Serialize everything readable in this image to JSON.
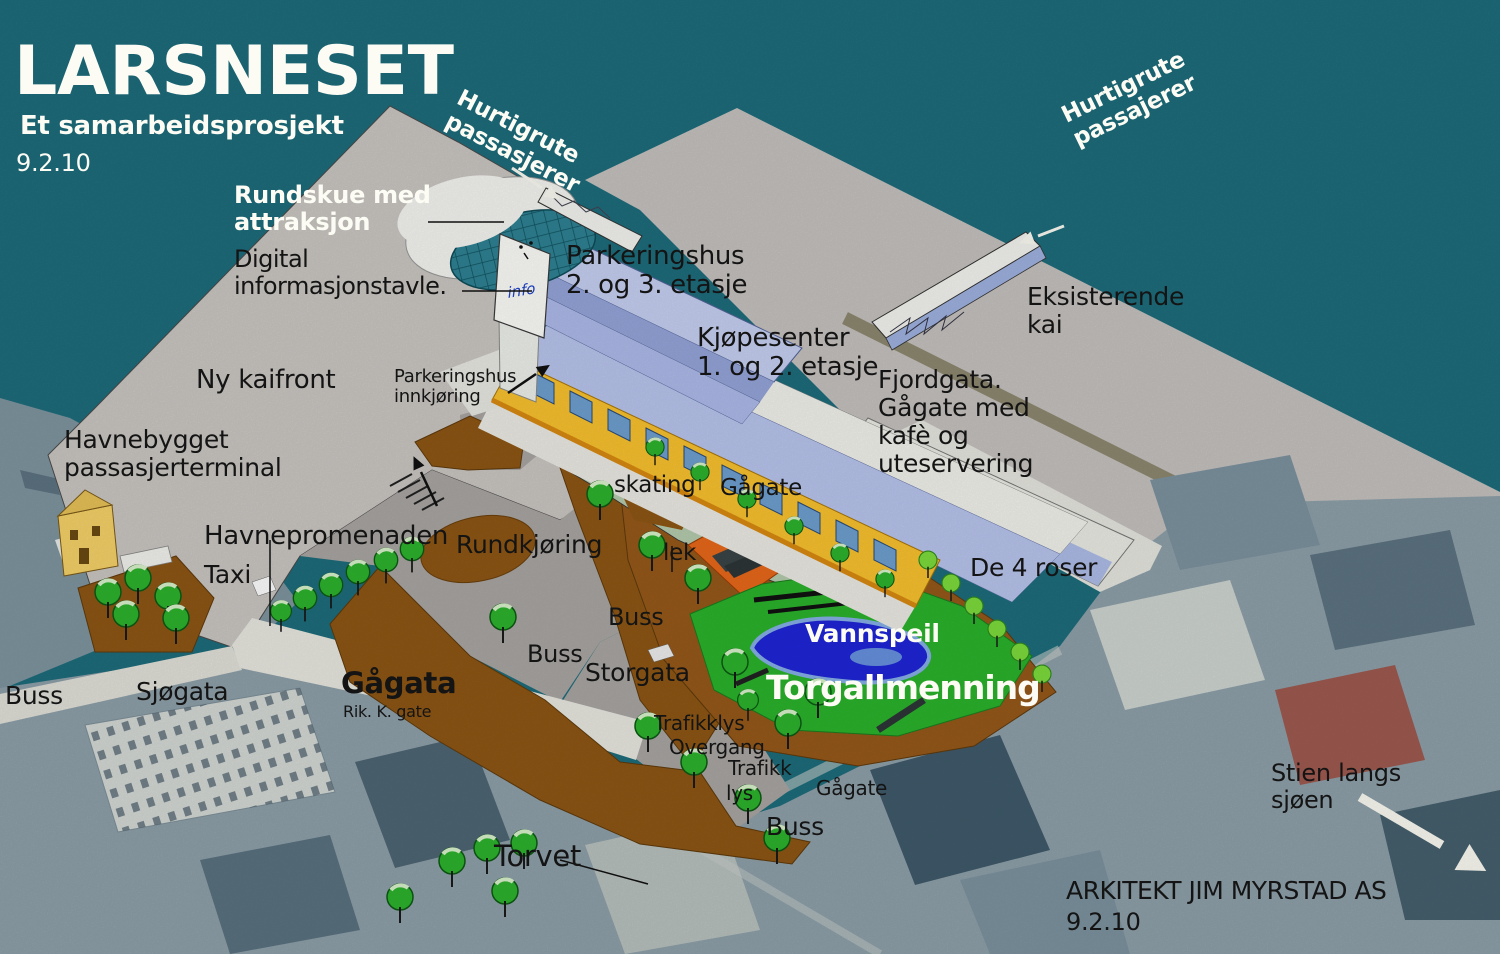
{
  "map": {
    "info_sign": "info"
  },
  "colors": {
    "water": "#1e6d7c",
    "new_quay": "#cbc7c3",
    "existing_quay": "#c6c2bf",
    "park_green": "#2bb32c",
    "skate_park_sage": "#b6ccae",
    "pond_blue": "#1f25d8",
    "earth_brown": "#8e5714",
    "facade_yellow": "#f9c22e",
    "parking_blue": "#aebbea",
    "roof_blue": "#b9c5ee",
    "dome_teal": "#2f8294",
    "tree_green": "#2db32d"
  },
  "annotations": [
    {
      "name": "title",
      "text": "LARSNESET",
      "x": 14,
      "y": 34,
      "size": 68,
      "color": "white",
      "bold": true
    },
    {
      "name": "subtitle",
      "text": "Et samarbeidsprosjekt",
      "x": 20,
      "y": 112,
      "size": 26,
      "color": "white",
      "bold": true
    },
    {
      "name": "title-date",
      "text": "9.2.10",
      "x": 16,
      "y": 150,
      "size": 24,
      "color": "white"
    },
    {
      "name": "hurtigrute-left",
      "text": "Hurtigrute\npassasjerer",
      "x": 464,
      "y": 86,
      "size": 23,
      "color": "white",
      "bold": true,
      "rot": 27
    },
    {
      "name": "rundskue",
      "text": "Rundskue med\nattraksjon",
      "x": 234,
      "y": 182,
      "size": 24,
      "color": "white",
      "bold": true
    },
    {
      "name": "digital-informasjonstavle",
      "text": "Digital\ninformasjonstavle.",
      "x": 234,
      "y": 246,
      "size": 24,
      "color": "black",
      "ls": -0.5
    },
    {
      "name": "parkeringshus",
      "text": "Parkeringshus\n2. og 3. etasje",
      "x": 566,
      "y": 242,
      "size": 26,
      "color": "black"
    },
    {
      "name": "kjopesenter",
      "text": "Kjøpesenter\n1. og 2. etasje",
      "x": 697,
      "y": 324,
      "size": 26,
      "color": "black"
    },
    {
      "name": "hurtigrute-right",
      "text": "Hurtigrute\npassajerer",
      "x": 1058,
      "y": 106,
      "size": 23,
      "color": "white",
      "bold": true,
      "rot": -26
    },
    {
      "name": "eksisterende-kai",
      "text": "Eksisterende\nkai",
      "x": 1027,
      "y": 283,
      "size": 25,
      "color": "black"
    },
    {
      "name": "fjordgata",
      "text": "Fjordgata.\nGågate med\nkafè og\nuteservering",
      "x": 878,
      "y": 366,
      "size": 25,
      "color": "black"
    },
    {
      "name": "ny-kaifront",
      "text": "Ny kaifront",
      "x": 196,
      "y": 366,
      "size": 26,
      "color": "black"
    },
    {
      "name": "parkeringshus-innkjoring",
      "text": "Parkeringshus\ninnkjøring",
      "x": 394,
      "y": 367,
      "size": 18,
      "color": "black"
    },
    {
      "name": "havnebygget",
      "text": "Havnebygget\npassasjerterminal",
      "x": 64,
      "y": 426,
      "size": 25,
      "color": "black"
    },
    {
      "name": "havnepromenaden",
      "text": "Havnepromenaden",
      "x": 204,
      "y": 522,
      "size": 26,
      "color": "black"
    },
    {
      "name": "taxi",
      "text": "Taxi",
      "x": 204,
      "y": 561,
      "size": 25,
      "color": "black"
    },
    {
      "name": "rundkjoring",
      "text": "Rundkjøring",
      "x": 456,
      "y": 531,
      "size": 25,
      "color": "black"
    },
    {
      "name": "skating",
      "text": "skating",
      "x": 614,
      "y": 473,
      "size": 23,
      "color": "black"
    },
    {
      "name": "gagate-upper",
      "text": "Gågate",
      "x": 720,
      "y": 476,
      "size": 23,
      "color": "black"
    },
    {
      "name": "lek",
      "text": "lek",
      "x": 663,
      "y": 541,
      "size": 23,
      "color": "black"
    },
    {
      "name": "buss-lekepark",
      "text": "Buss",
      "x": 608,
      "y": 604,
      "size": 24,
      "color": "black"
    },
    {
      "name": "buss-storgata",
      "text": "Buss",
      "x": 527,
      "y": 641,
      "size": 24,
      "color": "black"
    },
    {
      "name": "storgata",
      "text": "Storgata",
      "x": 585,
      "y": 659,
      "size": 25,
      "color": "black"
    },
    {
      "name": "vannspeil",
      "text": "Vannspeil",
      "x": 805,
      "y": 620,
      "size": 25,
      "color": "white",
      "bold": true
    },
    {
      "name": "torgallmenning",
      "text": "Torgallmenning",
      "x": 766,
      "y": 670,
      "size": 33,
      "color": "white",
      "bold": true,
      "ls": -1
    },
    {
      "name": "de-4-roser",
      "text": "De 4 roser",
      "x": 970,
      "y": 554,
      "size": 25,
      "color": "black"
    },
    {
      "name": "trafikklys",
      "text": "Trafikklys",
      "x": 654,
      "y": 712,
      "size": 20,
      "color": "black"
    },
    {
      "name": "overgang",
      "text": "Overgang",
      "x": 669,
      "y": 736,
      "size": 20,
      "color": "black"
    },
    {
      "name": "trafikk",
      "text": "Trafikk",
      "x": 728,
      "y": 757,
      "size": 20,
      "color": "black"
    },
    {
      "name": "lys",
      "text": "lys",
      "x": 726,
      "y": 782,
      "size": 20,
      "color": "black"
    },
    {
      "name": "gagate-lower",
      "text": "Gågate",
      "x": 816,
      "y": 777,
      "size": 20,
      "color": "black"
    },
    {
      "name": "buss-sor",
      "text": "Buss",
      "x": 766,
      "y": 813,
      "size": 25,
      "color": "black"
    },
    {
      "name": "buss-vest",
      "text": "Buss",
      "x": 5,
      "y": 682,
      "size": 25,
      "color": "black"
    },
    {
      "name": "sjogata",
      "text": "Sjøgata",
      "x": 136,
      "y": 678,
      "size": 25,
      "color": "black"
    },
    {
      "name": "gagata",
      "text": "Gågata",
      "x": 341,
      "y": 667,
      "size": 29,
      "color": "black",
      "bold": true
    },
    {
      "name": "rik-k-gate",
      "text": "Rik. K. gate",
      "x": 343,
      "y": 703,
      "size": 16,
      "color": "black"
    },
    {
      "name": "torvet",
      "text": "Torvet",
      "x": 494,
      "y": 840,
      "size": 29,
      "color": "black"
    },
    {
      "name": "stien-langs-sjoen",
      "text": "Stien langs\nsjøen",
      "x": 1271,
      "y": 760,
      "size": 24,
      "color": "black"
    },
    {
      "name": "arkitekt",
      "text": "ARKITEKT JIM MYRSTAD AS",
      "x": 1066,
      "y": 877,
      "size": 25,
      "color": "black",
      "ls": -0.5
    },
    {
      "name": "arkitekt-date",
      "text": "9.2.10",
      "x": 1066,
      "y": 909,
      "size": 24,
      "color": "black"
    }
  ]
}
